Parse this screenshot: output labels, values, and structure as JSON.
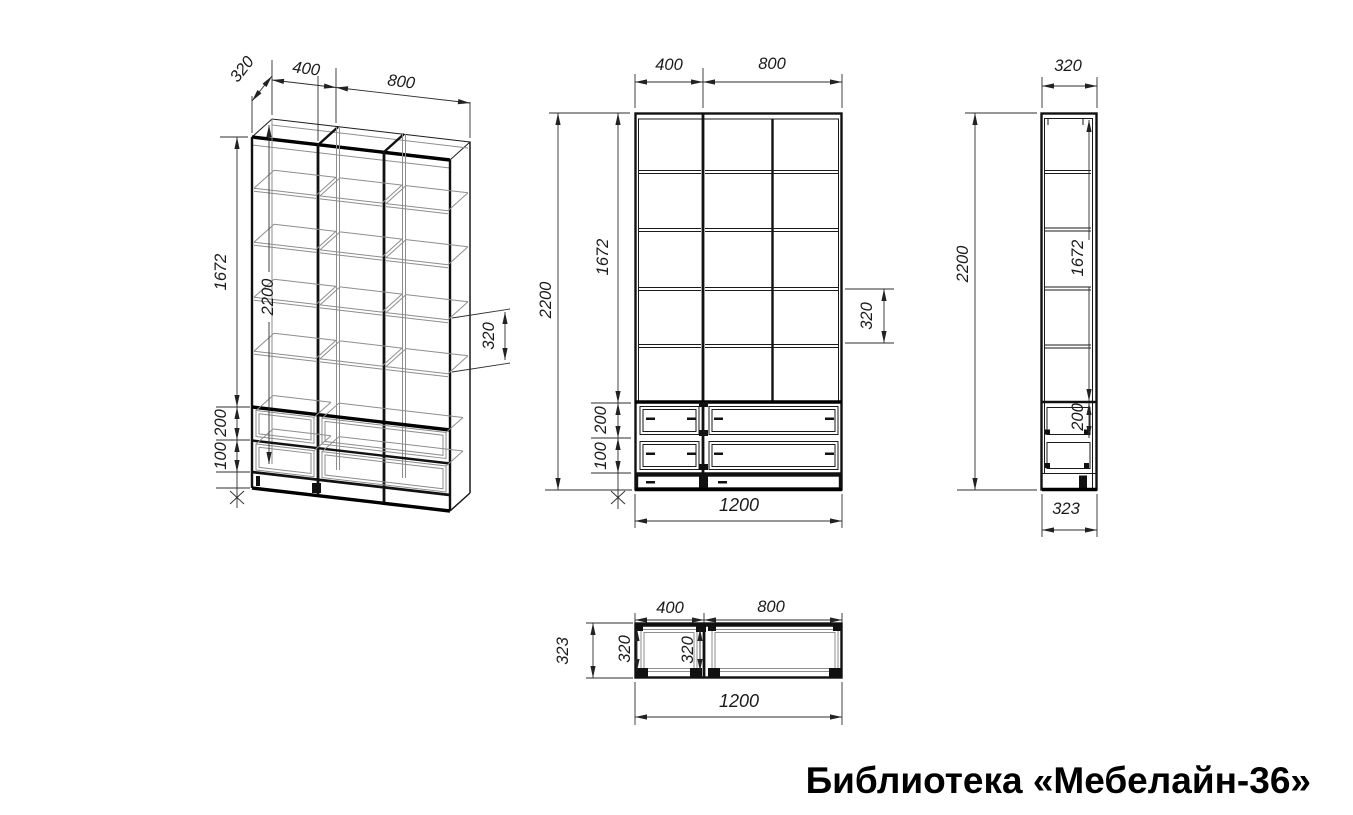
{
  "title": "Библиотека «Мебелайн-36»",
  "drawing": {
    "iso": {
      "depth": "320",
      "left_width": "400",
      "right_width": "800",
      "shelf_zone": "1672",
      "height": "2200",
      "drawer": "200",
      "plinth": "100",
      "spacing": "320"
    },
    "front": {
      "left_width": "400",
      "right_width": "800",
      "height": "2200",
      "shelf_zone": "1672",
      "drawer": "200",
      "plinth": "100",
      "spacing": "320",
      "width": "1200"
    },
    "side": {
      "depth": "320",
      "height": "2200",
      "shelf_zone": "1672",
      "drawer": "200",
      "base_depth": "323"
    },
    "top": {
      "left_width": "400",
      "right_width": "800",
      "base_depth": "323",
      "inner_depth_left": "320",
      "inner_depth_right": "320",
      "width": "1200"
    }
  }
}
